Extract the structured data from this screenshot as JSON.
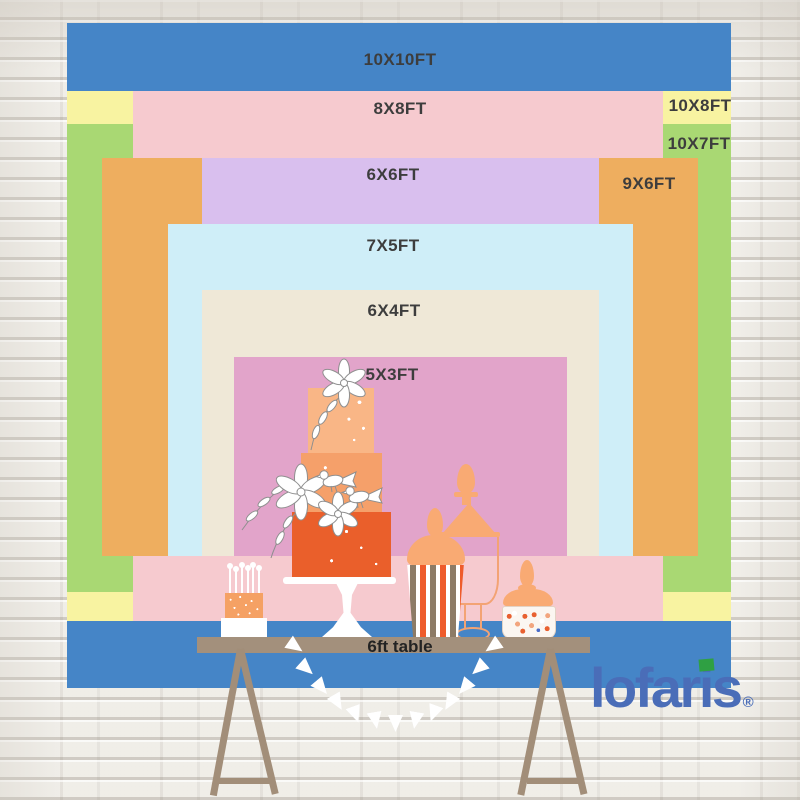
{
  "backdrop": {
    "sizes": [
      {
        "id": "10x10",
        "label": "10X10FT",
        "color": "#4585c7"
      },
      {
        "id": "8x8",
        "label": "8X8FT",
        "color": "#f6cacf"
      },
      {
        "id": "10x8",
        "label": "10X8FT",
        "color": "#f8f3a1"
      },
      {
        "id": "10x7",
        "label": "10X7FT",
        "color": "#a9d873"
      },
      {
        "id": "6x6",
        "label": "6X6FT",
        "color": "#d9bfee"
      },
      {
        "id": "9x6",
        "label": "9X6FT",
        "color": "#eeae5f"
      },
      {
        "id": "7x5",
        "label": "7X5FT",
        "color": "#cfeef8"
      },
      {
        "id": "6x4",
        "label": "6X4FT",
        "color": "#efe8d7"
      },
      {
        "id": "5x3",
        "label": "5X3FT",
        "color": "#e2a4ca"
      }
    ],
    "label_text_color": "#3d3d3d"
  },
  "table": {
    "label": "6ft table",
    "wood_color": "#a3907c"
  },
  "logo": {
    "text": "lofaris",
    "part_start": "lofar",
    "part_i": "i",
    "part_end": "s",
    "registered": "®",
    "color": "#4a6db8",
    "accent_green": "#2fa043"
  },
  "palette": {
    "wall": "#eceae4",
    "cake_top_tier": "#f9b686",
    "cake_middle_tier": "#f5a06a",
    "cake_bottom_tier": "#ea5f2b",
    "jar_orange": "#f9aa73",
    "stripe_orange": "#ee5c2c",
    "stripe_taupe": "#8d7b66"
  }
}
